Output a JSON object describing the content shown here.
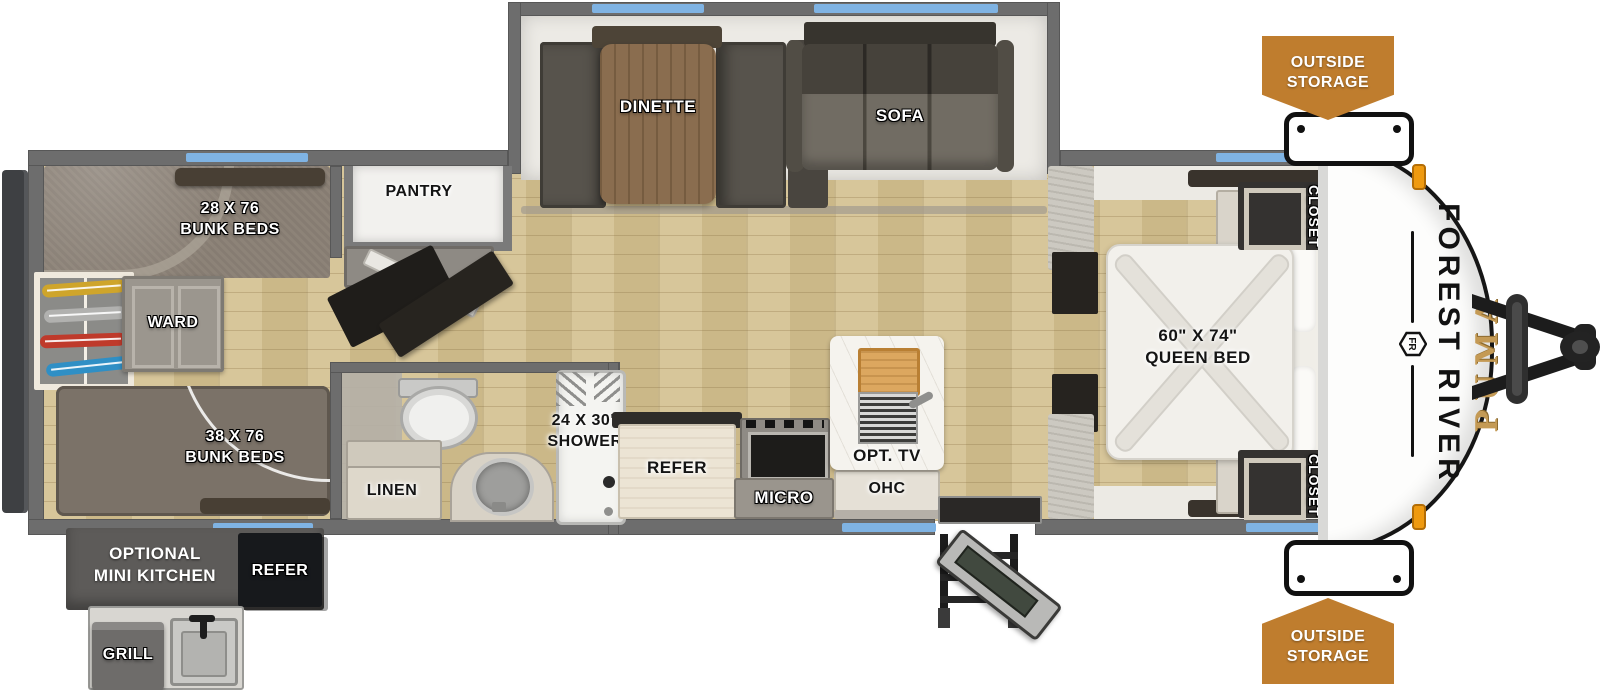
{
  "colors": {
    "accent_orange": "#BF7D2E",
    "window_blue": "#7FB3E3",
    "brand_gold": "#C49A55",
    "wall_gray": "#6D6D6D"
  },
  "slideout": {
    "dinette_label": "DINETTE",
    "sofa_label": "SOFA"
  },
  "bunk_room": {
    "top_bunk_size": "28 X 76",
    "top_bunk_label": "BUNK BEDS",
    "bottom_bunk_size": "38 X 76",
    "bottom_bunk_label": "BUNK BEDS",
    "wardrobe_label": "WARD"
  },
  "storage": {
    "pantry_label": "PANTRY",
    "linen_label": "LINEN",
    "closet_top_label": "CLOSET",
    "closet_bottom_label": "CLOSET",
    "outside_storage_top_line1": "OUTSIDE",
    "outside_storage_top_line2": "STORAGE",
    "outside_storage_bottom_line1": "OUTSIDE",
    "outside_storage_bottom_line2": "STORAGE"
  },
  "bathroom": {
    "shower_size": "24 X 30\"",
    "shower_label": "SHOWER"
  },
  "kitchen": {
    "refer_label": "REFER",
    "micro_label": "MICRO",
    "ohc_label": "OHC",
    "opt_tv_label": "OPT. TV"
  },
  "bedroom": {
    "bed_size": "60\" X 74\"",
    "bed_label": "QUEEN BED"
  },
  "exterior_kitchen": {
    "line1": "OPTIONAL",
    "line2": "MINI KITCHEN",
    "refer_label": "REFER",
    "grill_label": "GRILL"
  },
  "branding": {
    "make": "FOREST RIVER",
    "model": "PUMA",
    "monogram": "FR"
  }
}
